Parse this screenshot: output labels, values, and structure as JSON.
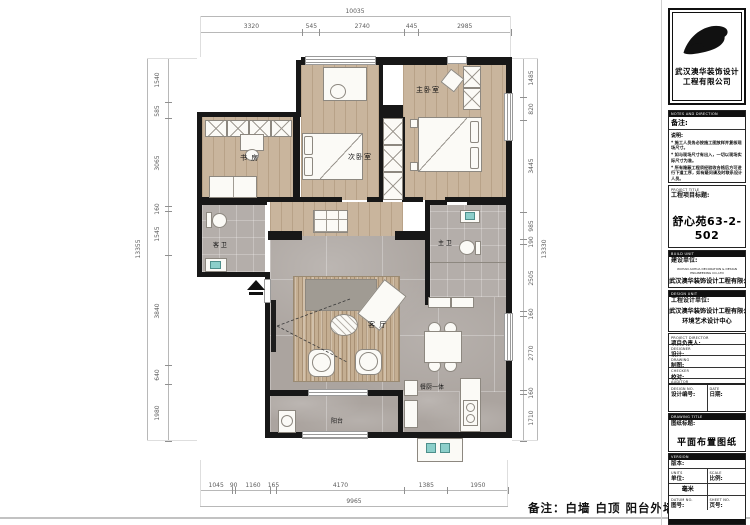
{
  "bottom_note": "备注：白墙 白顶 阳台外墙涂料",
  "plan": {
    "rooms": {
      "master_bedroom": "主卧室",
      "second_bedroom": "次卧室",
      "study": "书 房",
      "guest_bath": "客 卫",
      "master_bath": "主 卫",
      "living": "客 厅",
      "dining_kitchen": "餐厨一体",
      "balcony": "阳台"
    },
    "dimensions": {
      "top": {
        "overall": "10035",
        "segments": [
          3320,
          545,
          2740,
          445,
          2985
        ]
      },
      "bottom": {
        "overall": "9965",
        "segments": [
          1045,
          90,
          1160,
          165,
          4170,
          1385,
          1950
        ]
      },
      "left": {
        "overall": "13355",
        "segments": [
          1540,
          585,
          3065,
          160,
          1545,
          3840,
          640,
          1980
        ]
      },
      "right": {
        "overall": "13330",
        "segments": [
          1485,
          820,
          3445,
          985,
          190,
          2505,
          160,
          2770,
          160,
          1710
        ]
      }
    }
  },
  "title_block": {
    "company_cn": "武汉澳华装饰设计",
    "company_cn2": "工程有限公司",
    "notes": {
      "en": "NOTES AND DIRECTION",
      "label": "备注:",
      "sub": "说明:",
      "items": [
        "施工人员务必按施工图放样并复核现场尺寸。",
        "如与现场尺寸有出入，一切以现场实际尺寸为准。",
        "所有隐蔽工程须经验收合格后方可进行下道工序，如有疑问请及时联系设计人员。",
        "图内所标尺寸，以标注尺寸为准。",
        "墙体拆改均需经物业审批后方可施工。",
        "未尽事宜参照本公司相关施工规范及图集执行。"
      ]
    },
    "project": {
      "en": "PROJECT TITLE",
      "label": "工程项目标题:",
      "value": "舒心苑63-2-502"
    },
    "build_unit": {
      "en": "BUILD UNIT",
      "label": "建设单位:",
      "value_en": "WUHAN AOHUA DECORATION & DESIGN ENGINEERING CO.,LTD",
      "value": "武汉澳华装饰设计工程有限公司"
    },
    "design_unit": {
      "en": "DESIGN UNIT",
      "label": "工程设计单位:",
      "value": "武汉澳华装饰设计工程有限公司",
      "value2": "环境艺术设计中心"
    },
    "rows": [
      {
        "en": "PROJECT DIRECTOR",
        "label": "项目负责人:"
      },
      {
        "en": "DESIGNER",
        "label": "设计:"
      },
      {
        "en": "DRAWING",
        "label": "制图:"
      },
      {
        "en": "CHECKER",
        "label": "校对:"
      },
      {
        "en": "AUDITOR",
        "label": "审核:"
      }
    ],
    "design_no": {
      "en": "DESIGN NO.",
      "label": "设计编号:"
    },
    "date": {
      "en": "DATE",
      "label": "日期:"
    },
    "drawing_title": {
      "en": "DRAWING TITLE",
      "label": "图纸标题:",
      "value": "平面布置图纸"
    },
    "version": {
      "en": "VERSION",
      "label": "版本:"
    },
    "units": {
      "en": "UNITS",
      "label": "单位:",
      "value": "毫米"
    },
    "scale": {
      "en": "SCALE",
      "label": "比例:"
    },
    "datum_no": {
      "en": "DATUM NO.",
      "label": "图号:"
    },
    "sheet_no": {
      "en": "SHEET NO.",
      "label": "页号:"
    }
  }
}
